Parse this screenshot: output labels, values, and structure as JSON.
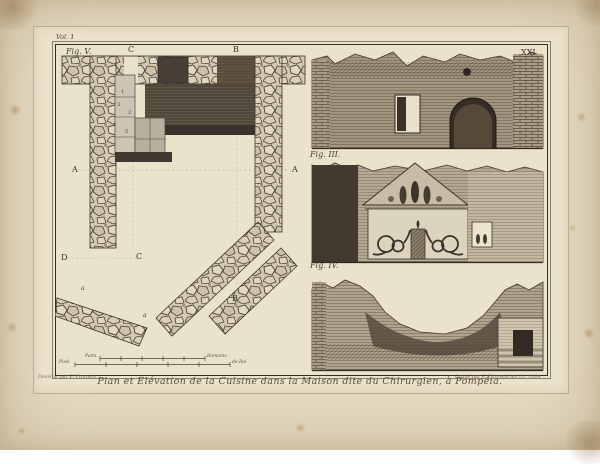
{
  "artwork": {
    "volume_label": "Vol. 1",
    "plate_number": "XXI",
    "caption": "Plan et Élévation de la Cuisine dans la Maison dite du Chirurgien, à Pompéia.",
    "credit_left": "Dessiné par F. Piranesi",
    "credit_right": "Gravé par F. Piranesi An 13. 1804"
  },
  "plan": {
    "figure_label": "Fig. V.",
    "letters": {
      "c_top": "C",
      "b_top": "B",
      "a_left": "A",
      "a_right": "A",
      "d_mid": "D",
      "c_mid": "C",
      "b_low": "B",
      "a_small_1": "a",
      "a_small_2": "a"
    },
    "numbers": {
      "n1": "1",
      "n2": "2",
      "n3": "3",
      "n4": "4",
      "n5": "5"
    },
    "scale_bars": {
      "palms_left": "Palm.",
      "palms_right": "Romains",
      "feet_left": "Pied.",
      "feet_right": "de Roi"
    }
  },
  "elevations": {
    "fig3_label": "Fig. III.",
    "fig4_label": "Fig. IV."
  },
  "colors": {
    "paper": "#e7ddc5",
    "plate": "#ebe2cb",
    "ink": "#332c22",
    "stone": "#d7cdb6",
    "dark_wash": "#51473b"
  }
}
